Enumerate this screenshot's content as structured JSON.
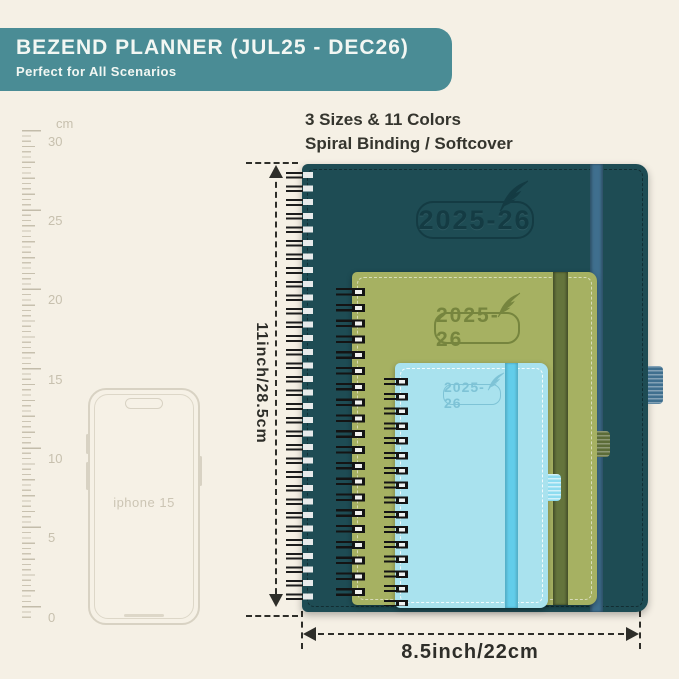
{
  "header": {
    "title": "BEZEND PLANNER (JUL25 - DEC26)",
    "subtitle": "Perfect for All Scenarios",
    "bg_color": "#4a8c95"
  },
  "info": {
    "line1": "3 Sizes & 11 Colors",
    "line2": "Spiral Binding / Softcover"
  },
  "ruler": {
    "unit": "cm",
    "labels": [
      "30",
      "25",
      "20",
      "15",
      "10",
      "5",
      "0"
    ]
  },
  "phone": {
    "label": "iphone 15"
  },
  "dimensions": {
    "height_label": "11inch/28.5cm",
    "width_label": "8.5inch/22cm"
  },
  "planners": {
    "large": {
      "year": "2025-26",
      "cover_color": "#1e4c54",
      "band_color": "#3f6f8e"
    },
    "medium": {
      "year": "2025-26",
      "cover_color": "#a6b162",
      "band_color": "#64743c"
    },
    "small": {
      "year": "2025-26",
      "cover_color": "#a9e2ee",
      "band_color": "#62cdea"
    }
  },
  "background_color": "#f5f0e5"
}
